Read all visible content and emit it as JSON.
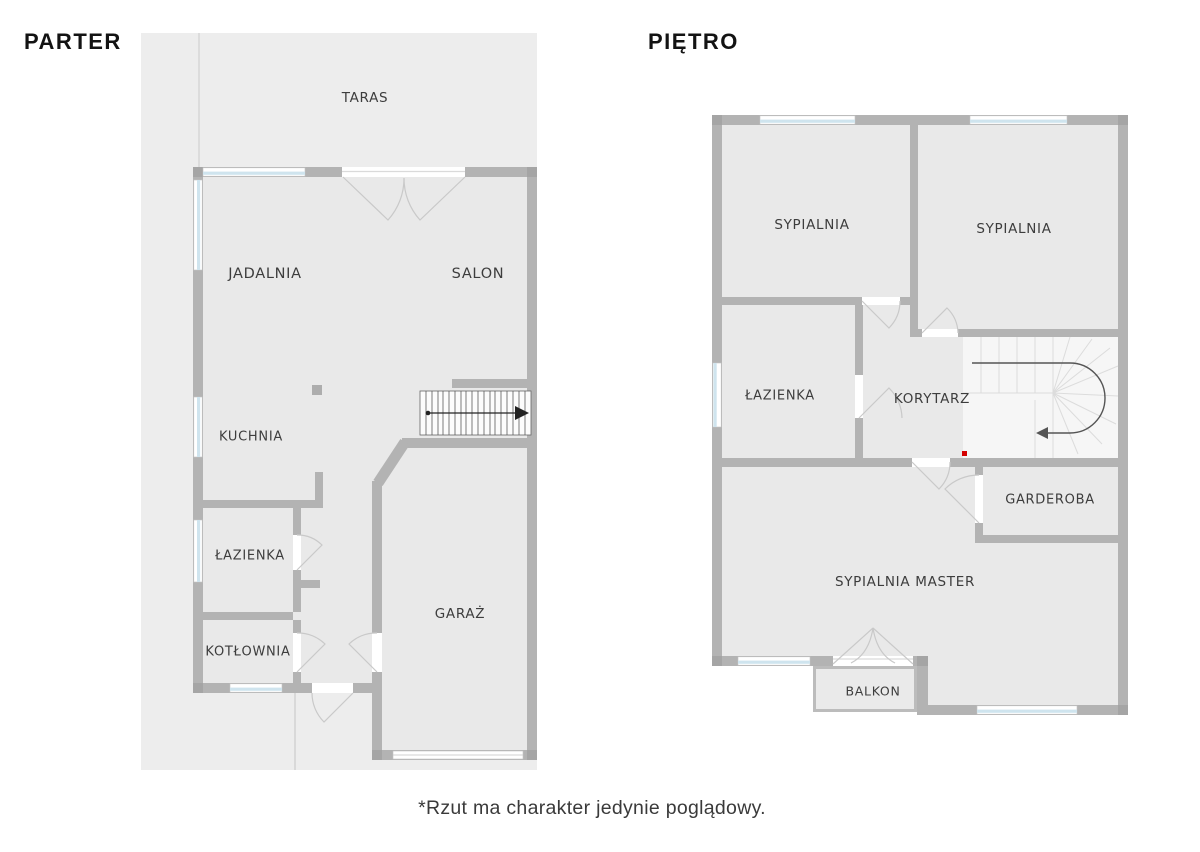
{
  "floors": [
    {
      "title": "PARTER",
      "rooms": [
        {
          "label": "TARAS"
        },
        {
          "label": "JADALNIA"
        },
        {
          "label": "SALON"
        },
        {
          "label": "KUCHNIA"
        },
        {
          "label": "ŁAZIENKA"
        },
        {
          "label": "KOTŁOWNIA"
        },
        {
          "label": "GARAŻ"
        }
      ]
    },
    {
      "title": "PIĘTRO",
      "rooms": [
        {
          "label": "SYPIALNIA"
        },
        {
          "label": "SYPIALNIA"
        },
        {
          "label": "ŁAZIENKA"
        },
        {
          "label": "KORYTARZ"
        },
        {
          "label": "GARDEROBA"
        },
        {
          "label": "SYPIALNIA MASTER"
        },
        {
          "label": "BALKON"
        }
      ]
    }
  ],
  "footnote": {
    "text": "*Rzut ma charakter jedynie poglądowy."
  },
  "colors": {
    "wall": "#b3b3b3",
    "wall_corner": "#a5a5a5",
    "room_fill": "#e9e9e9",
    "site_fill": "#ededed",
    "window_glass": "#cfe4ee",
    "stair_tread_dark": "#555555",
    "stair_tread_light": "#dcdcdc",
    "red_marker": "#d40000",
    "label_text": "#3d3d3d",
    "title_text": "#131313"
  }
}
